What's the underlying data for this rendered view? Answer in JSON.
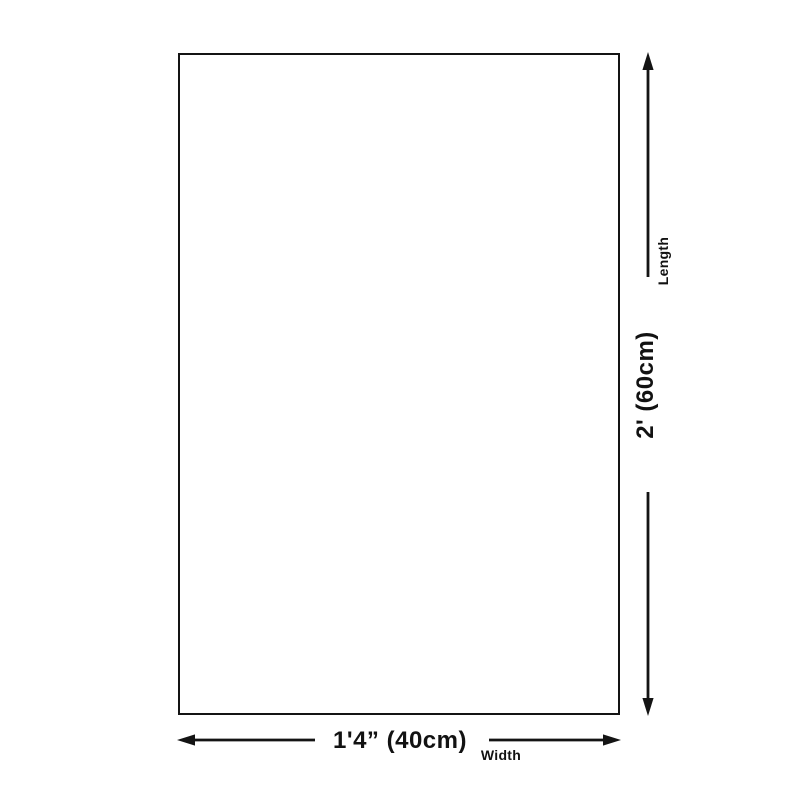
{
  "page": {
    "background_color": "#ffffff"
  },
  "diagram": {
    "line_color": "#141414",
    "text_color": "#121212",
    "product_outline": "rectangle",
    "dimensions": {
      "vertical": {
        "name_label": "Length",
        "value_label": "2' (60cm)"
      },
      "horizontal": {
        "name_label": "Width",
        "value_label": "1'4” (40cm)"
      }
    }
  }
}
